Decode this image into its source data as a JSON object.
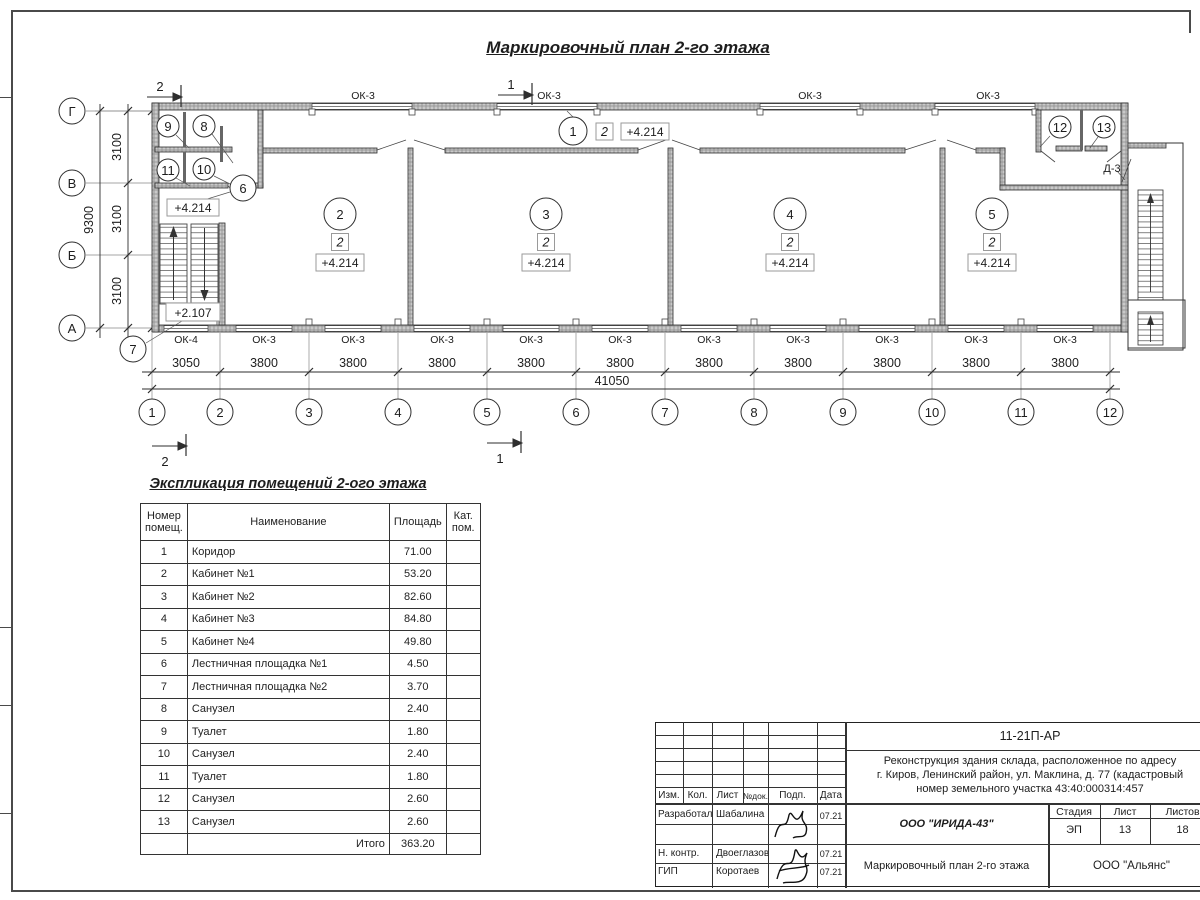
{
  "page": {
    "plan_title": "Маркировочный план 2-го этажа",
    "table_title": "Экспликация помещений 2-ого этажа"
  },
  "plan": {
    "cols": [
      "1",
      "2",
      "3",
      "4",
      "5",
      "6",
      "7",
      "8",
      "9",
      "10",
      "11",
      "12"
    ],
    "rows": [
      "Г",
      "В",
      "Б",
      "А"
    ],
    "dims": {
      "bottom": [
        "3050",
        "3800",
        "3800",
        "3800",
        "3800",
        "3800",
        "3800",
        "3800",
        "3800",
        "3800",
        "3800"
      ],
      "total": "41050",
      "left": [
        "3100",
        "3100",
        "3100"
      ],
      "left_total": "9300"
    },
    "windows": {
      "top": [
        "ОК-3",
        "ОК-3",
        "ОК-3",
        "ОК-3"
      ],
      "bottom": [
        "ОК-4",
        "ОК-3",
        "ОК-3",
        "ОК-3",
        "ОК-3",
        "ОК-3",
        "ОК-3",
        "ОК-3",
        "ОК-3",
        "ОК-3",
        "ОК-3"
      ]
    },
    "room_numbers": [
      "1",
      "2",
      "3",
      "4",
      "5",
      "6",
      "7",
      "8",
      "9",
      "10",
      "11",
      "12",
      "13"
    ],
    "category": "2",
    "elev_main": "+4.214",
    "elev_stair": "+2.107",
    "door_label": "Д-3",
    "section_marks": {
      "s1": "1",
      "s2": "2"
    }
  },
  "table": {
    "headers": {
      "num": "Номер помещ.",
      "name": "Наименование",
      "area": "Площадь",
      "cat": "Кат. пом."
    },
    "rows": [
      [
        "1",
        "Коридор",
        "71.00"
      ],
      [
        "2",
        "Кабинет №1",
        "53.20"
      ],
      [
        "3",
        "Кабинет №2",
        "82.60"
      ],
      [
        "4",
        "Кабинет №3",
        "84.80"
      ],
      [
        "5",
        "Кабинет №4",
        "49.80"
      ],
      [
        "6",
        "Лестничная площадка №1",
        "4.50"
      ],
      [
        "7",
        "Лестничная площадка №2",
        "3.70"
      ],
      [
        "8",
        "Санузел",
        "2.40"
      ],
      [
        "9",
        "Туалет",
        "1.80"
      ],
      [
        "10",
        "Санузел",
        "2.40"
      ],
      [
        "11",
        "Туалет",
        "1.80"
      ],
      [
        "12",
        "Санузел",
        "2.60"
      ],
      [
        "13",
        "Санузел",
        "2.60"
      ]
    ],
    "total_label": "Итого",
    "total_value": "363.20"
  },
  "titleblock": {
    "code": "11-21П-АР",
    "project": [
      "Реконструкция здания склада, расположенное по адресу",
      "г. Киров, Ленинский район, ул. Маклина, д. 77 (кадастровый",
      "номер земельного участка 43:40:000314:457"
    ],
    "rev_headers": [
      "Изм.",
      "Кол.",
      "Лист",
      "№док.",
      "Подп.",
      "Дата"
    ],
    "staff": [
      {
        "role": "Разработал",
        "name": "Шабалина",
        "date": "07.21"
      },
      {
        "role": "Н. контр.",
        "name": "Двоеглазов",
        "date": "07.21"
      },
      {
        "role": "ГИП",
        "name": "Коротаев",
        "date": "07.21"
      }
    ],
    "org": "ООО \"ИРИДА-43\"",
    "doc_title": "Маркировочный план 2-го этажа",
    "stage_label": "Стадия",
    "sheet_label": "Лист",
    "sheets_label": "Листов",
    "stage": "ЭП",
    "sheet": "13",
    "sheets": "18",
    "company": "ООО \"Альянс\""
  }
}
